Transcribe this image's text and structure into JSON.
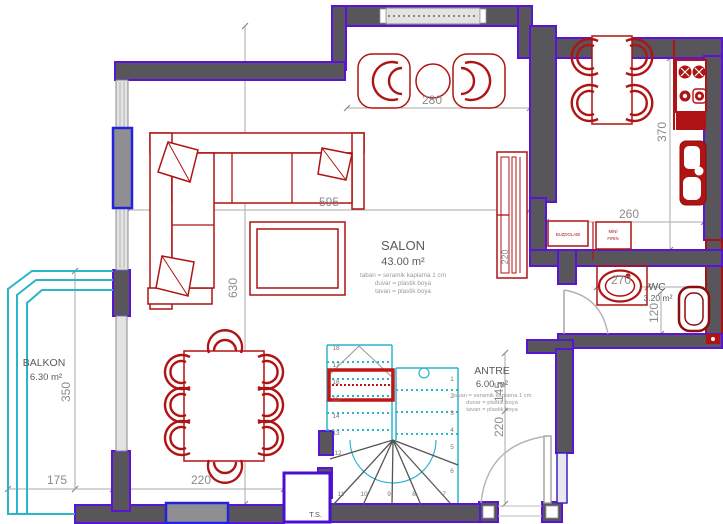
{
  "plan": {
    "rooms": {
      "salon": {
        "name": "SALON",
        "area": "43.00 m²",
        "spec1": "taban = seramik kaplama 1 cm",
        "spec2": "duvar = plastik boya",
        "spec3": "tavan = plastik boya"
      },
      "balkon": {
        "name": "BALKON",
        "area": "6.30 m²"
      },
      "antre": {
        "name": "ANTRE",
        "area": "6.00 m²",
        "spec1": "taban = seramik kaplama 1 cm",
        "spec2": "duvar = plastik boya",
        "spec3": "tavan = plastik boya"
      },
      "wc": {
        "name": "WC",
        "area": "3.20 m²"
      }
    },
    "labels": {
      "shaft": "T.S.",
      "fridge": "BUZDOLABI",
      "oven_line1": "MİNİ",
      "oven_line2": "FIRIN"
    },
    "dims": {
      "armchair_group": "280",
      "salon_width": "595",
      "salon_depth": "630",
      "balkon_depth": "350",
      "balkon_width": "175",
      "dining_width": "220",
      "kitchen_depth": "370",
      "counter_width": "260",
      "wc_width": "270",
      "wc_depth": "120",
      "antre_upper": "145",
      "antre_lower": "220",
      "slide_door": "220"
    },
    "stairs": {
      "steps": [
        "1",
        "2",
        "3",
        "4",
        "5",
        "6",
        "7",
        "8",
        "9",
        "10",
        "11",
        "12",
        "13",
        "14",
        "15",
        "16",
        "17",
        "18"
      ]
    },
    "colors": {
      "wall": "#58565b",
      "wall_outline": "#5a14d8",
      "furniture_red": "#b01313",
      "stair_cyan": "#2ab5cb",
      "window_blue": "#2323dd",
      "dim_gray": "#8a8a8a"
    }
  }
}
